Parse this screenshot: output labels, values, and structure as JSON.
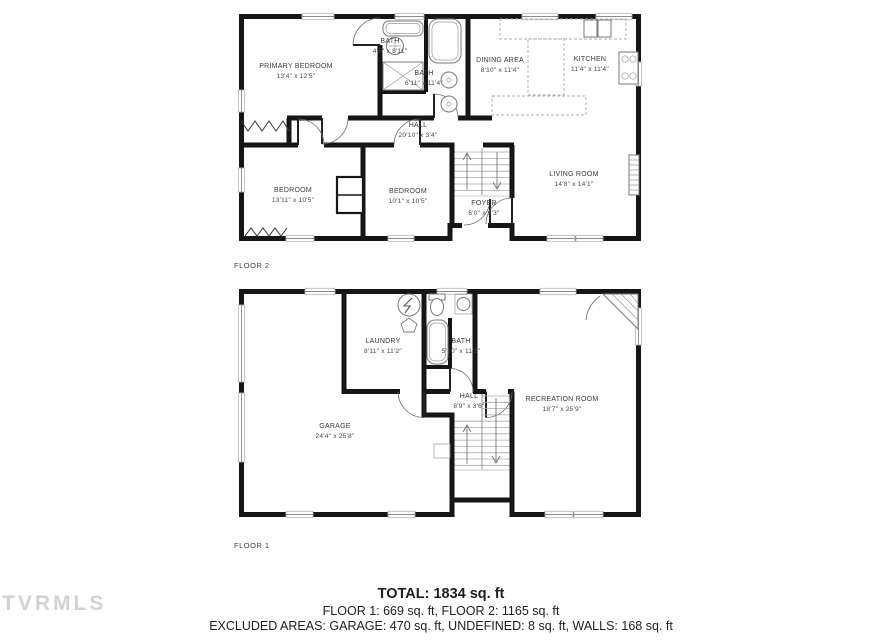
{
  "watermark": {
    "text": "TVRMLS"
  },
  "floor2": {
    "label": "FLOOR 2",
    "rooms": [
      {
        "name": "PRIMARY BEDROOM",
        "dims": "13'4\" x 12'5\""
      },
      {
        "name": "BATH",
        "dims": "4'5\" x 8'11\""
      },
      {
        "name": "BATH",
        "dims": "6'11\" x 11'4\""
      },
      {
        "name": "DINING AREA",
        "dims": "8'10\" x 11'4\""
      },
      {
        "name": "KITCHEN",
        "dims": "11'4\" x 11'4\""
      },
      {
        "name": "HALL",
        "dims": "20'10\" x 3'4\""
      },
      {
        "name": "BEDROOM",
        "dims": "13'11\" x 10'5\""
      },
      {
        "name": "BEDROOM",
        "dims": "10'1\" x 10'5\""
      },
      {
        "name": "FOYER",
        "dims": "6'0\" x 9'3\""
      },
      {
        "name": "LIVING ROOM",
        "dims": "14'8\" x 14'1\""
      }
    ]
  },
  "floor1": {
    "label": "FLOOR 1",
    "rooms": [
      {
        "name": "LAUNDRY",
        "dims": "8'11\" x 11'2\""
      },
      {
        "name": "BATH",
        "dims": "5'10\" x 11'2\""
      },
      {
        "name": "HALL",
        "dims": "8'9\" x 3'6\""
      },
      {
        "name": "RECREATION ROOM",
        "dims": "18'7\" x 25'9\""
      },
      {
        "name": "GARAGE",
        "dims": "24'4\" x 25'8\""
      }
    ]
  },
  "summary": {
    "total": "TOTAL: 1834 sq. ft",
    "floors": "FLOOR 1: 669 sq. ft, FLOOR 2: 1165 sq. ft",
    "excluded": "EXCLUDED AREAS: GARAGE: 470 sq. ft, UNDEFINED: 8 sq. ft, WALLS: 168 sq. ft"
  },
  "colors": {
    "wall": "#161616",
    "text": "#3a3a3a",
    "fixture": "#7a7a7a",
    "watermark": "#d2d2d2"
  }
}
